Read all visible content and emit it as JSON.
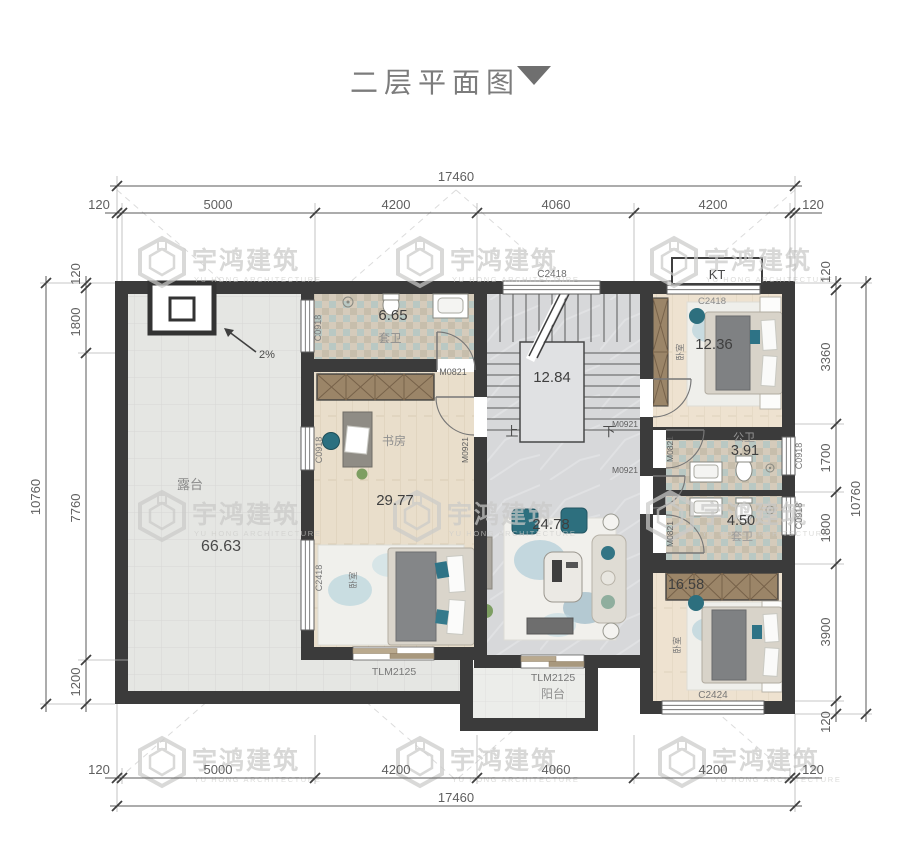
{
  "title": {
    "text": "二层平面图"
  },
  "watermark": {
    "cn": "宇鸿建筑",
    "en": "YU HONG ARCHITECTURE"
  },
  "dims": {
    "top_total": "17460",
    "top_segs": [
      "120",
      "5000",
      "4200",
      "4060",
      "4200",
      "120"
    ],
    "bottom_total": "17460",
    "bottom_segs": [
      "120",
      "5000",
      "4200",
      "4060",
      "4200",
      "120"
    ],
    "left_total": "10760",
    "left_segs": [
      "120",
      "1800",
      "7760",
      "1200"
    ],
    "right_total": "10760",
    "right_segs": [
      "120",
      "3360",
      "1700",
      "1800",
      "3900",
      "120"
    ]
  },
  "rooms": {
    "terrace": {
      "name": "露台",
      "area": "66.63",
      "slope": "2%"
    },
    "bath_top": {
      "name": "套卫",
      "area": "6.65"
    },
    "study": {
      "name": "书房"
    },
    "bedroom_left": {
      "name": "卧室",
      "area": "29.77"
    },
    "stairs": {
      "area": "12.84",
      "up": "上",
      "down": "下"
    },
    "hall": {
      "area": "24.78"
    },
    "bedroom_tr": {
      "name": "卧室",
      "area": "12.36"
    },
    "bath_shared": {
      "name": "公卫",
      "area": "3.91"
    },
    "bath_ensuite": {
      "name": "套卫",
      "area": "4.50"
    },
    "bedroom_br": {
      "name": "卧室",
      "area": "16.58"
    },
    "balcony": {
      "name": "阳台"
    },
    "ac_platform": {
      "name": "KT"
    }
  },
  "openings": {
    "win_stair_top": "C2418",
    "win_bedroom_tr": "C2418",
    "win_bath_top": "C0918",
    "win_study": "C0918",
    "win_bedroom_left": "C2418",
    "win_bath_shared": "C0918",
    "win_bath_ensuite": "C0918",
    "win_bedroom_br": "C2424",
    "door_bath_top": "M0821",
    "door_study": "M0921",
    "door_bedroom_tr": "M0921",
    "door_bath_shared": "M0821",
    "door_passage": "M0921",
    "door_bath_ensuite": "M0821",
    "slider_bedroom_left": "TLM2125",
    "slider_balcony": "TLM2125"
  }
}
